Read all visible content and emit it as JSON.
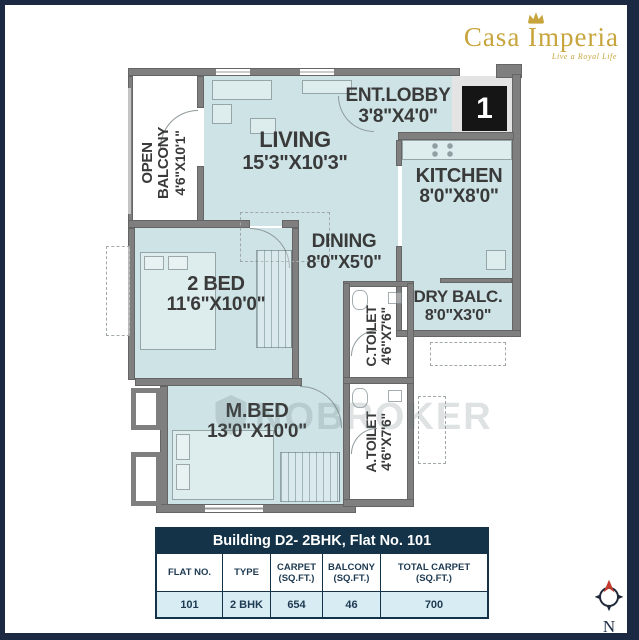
{
  "brand": {
    "name": "Casa Imperia",
    "tagline": "Live a Royal Life"
  },
  "unit_badge": "1",
  "watermark": "NOBROKER",
  "compass_label": "N",
  "rooms": {
    "ent_lobby": {
      "name": "ENT.LOBBY",
      "dims": "3'8\"X4'0\""
    },
    "living": {
      "name": "LIVING",
      "dims": "15'3\"X10'3\""
    },
    "kitchen": {
      "name": "KITCHEN",
      "dims": "8'0\"X8'0\""
    },
    "dining": {
      "name": "DINING",
      "dims": "8'0\"X5'0\""
    },
    "dry_balcony": {
      "name": "DRY BALC.",
      "dims": "8'0\"X3'0\""
    },
    "open_balcony": {
      "name": "OPEN BALCONY",
      "dims": "4'6\"X10'1\""
    },
    "bed2": {
      "name": "2 BED",
      "dims": "11'6\"X10'0\""
    },
    "mbed": {
      "name": "M.BED",
      "dims": "13'0\"X10'0\""
    },
    "c_toilet": {
      "name": "C.TOILET",
      "dims": "4'6\"X7'6\""
    },
    "a_toilet": {
      "name": "A.TOILET",
      "dims": "4'6\"X7'6\""
    }
  },
  "table": {
    "title": "Building D2- 2BHK, Flat No. 101",
    "headers": [
      "FLAT NO.",
      "TYPE",
      "CARPET\n(SQ.FT.)",
      "BALCONY\n(SQ.FT.)",
      "TOTAL CARPET\n(SQ.FT.)"
    ],
    "row": [
      "101",
      "2 BHK",
      "654",
      "46",
      "700"
    ]
  },
  "colors": {
    "frame_navy": "#1b2a42",
    "table_navy": "#143349",
    "room_fill": "#cde3e5",
    "wall_gray": "#7f7f7f",
    "row_blue": "#d8ecf4",
    "brand_gold": "#c7a53c",
    "compass_red": "#c23b2e"
  }
}
